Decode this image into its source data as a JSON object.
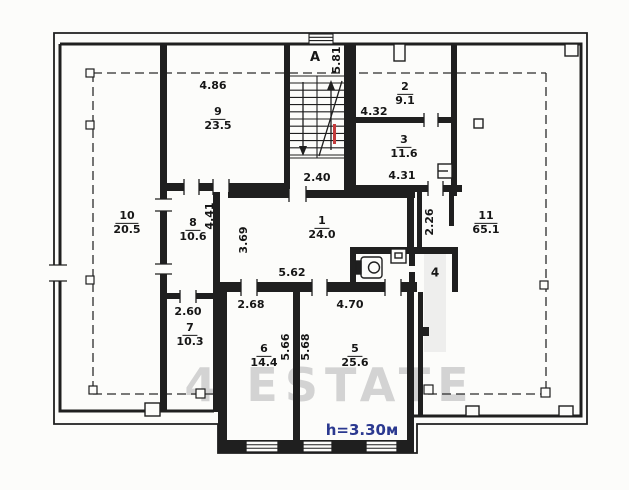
{
  "plan_title": "floor-plan",
  "watermark": "4 ESTATE",
  "ceiling_height_note": "h=3.30м",
  "stairwell": {
    "label": "A",
    "flight_dim": "5.81",
    "landing_dim": "2.40"
  },
  "rooms": {
    "r1": {
      "number": "1",
      "area": "24.0"
    },
    "r2": {
      "number": "2",
      "area": "9.1"
    },
    "r3": {
      "number": "3",
      "area": "11.6"
    },
    "r4": {
      "number": "4"
    },
    "r5": {
      "number": "5",
      "area": "25.6"
    },
    "r6": {
      "number": "6",
      "area": "14.4"
    },
    "r7": {
      "number": "7",
      "area": "10.3"
    },
    "r8": {
      "number": "8",
      "area": "10.6"
    },
    "r9": {
      "number": "9",
      "area": "23.5"
    },
    "r10": {
      "number": "10",
      "area": "20.5"
    },
    "r11": {
      "number": "11",
      "area": "65.1"
    }
  },
  "dims": {
    "room9_width": "4.86",
    "room2_width": "4.32",
    "room3_width": "4.31",
    "room8_length": "4.41",
    "room1_depth": "3.69",
    "room1_width": "5.62",
    "corridor_length": "2.26",
    "room7_width": "2.60",
    "room6_width": "2.68",
    "room5_width": "4.70",
    "room6_depth": "5.66",
    "room5_depth": "5.68"
  },
  "colors": {
    "line": "#1f1f1f",
    "flight_mark_red": "#c43b3b",
    "height_note_navy": "#2b3990",
    "watermark_gray": "#cdcdcd"
  }
}
